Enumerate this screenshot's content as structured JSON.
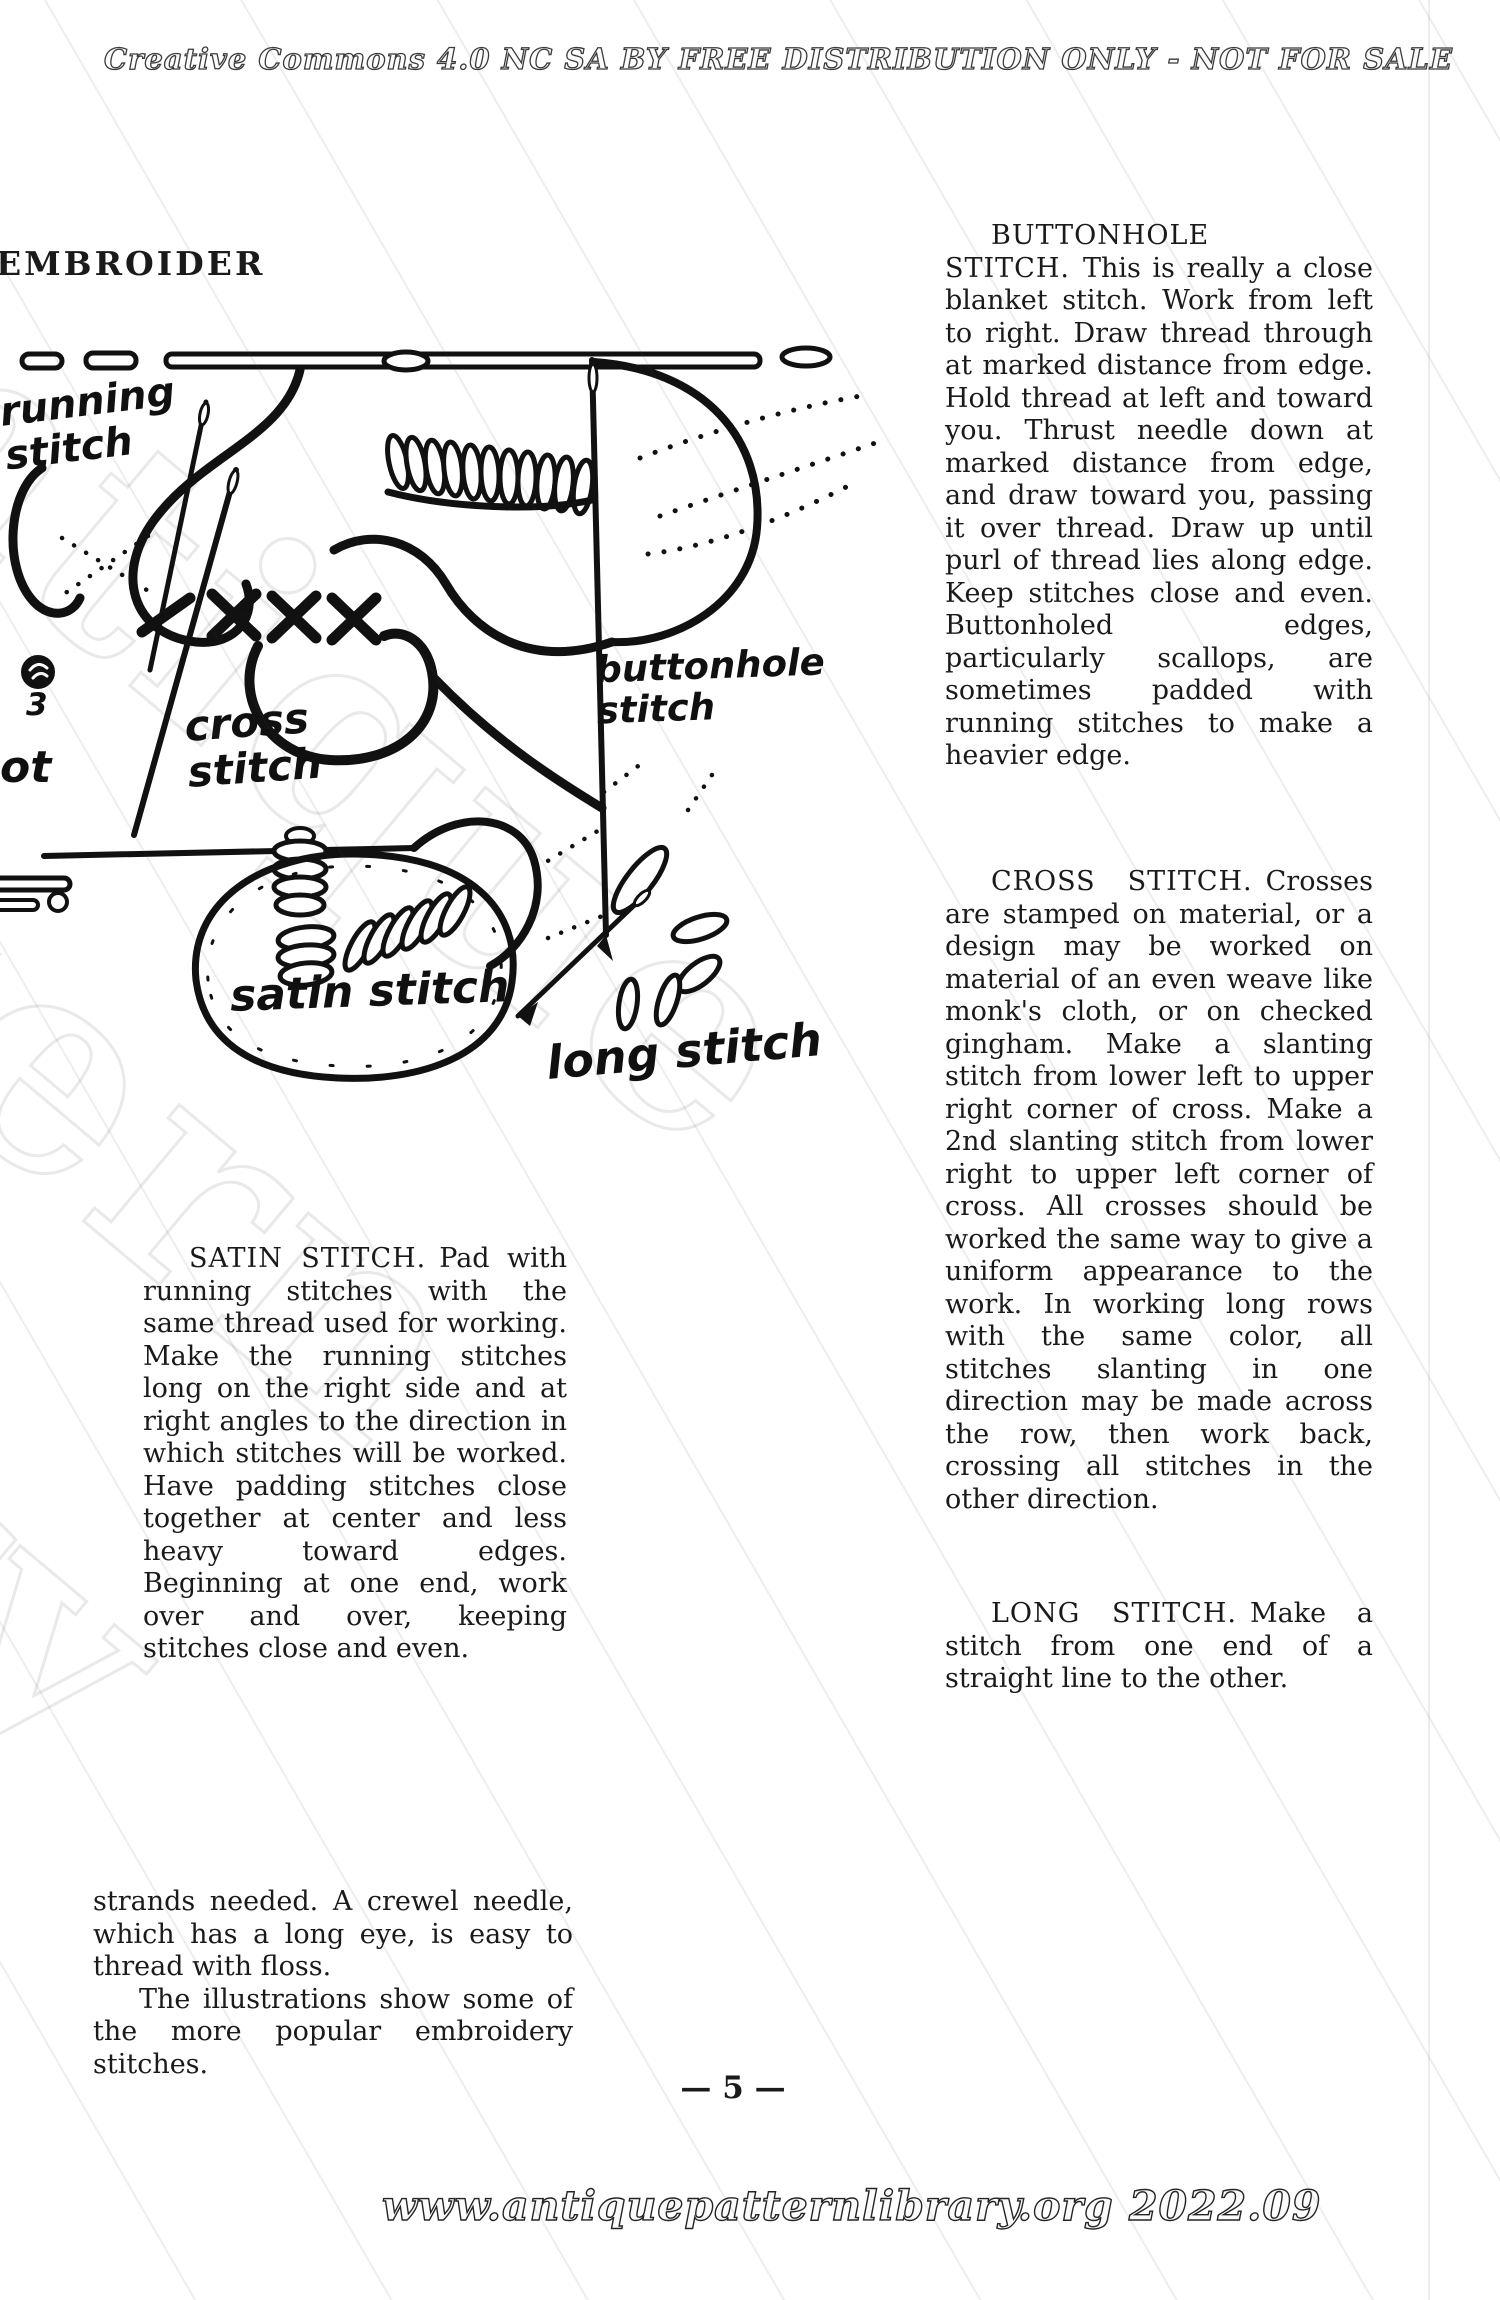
{
  "page": {
    "header": "Creative Commons 4.0 NC SA BY FREE DISTRIBUTION ONLY - NOT FOR SALE",
    "watermark": "Antique Pattern Library",
    "page_number": "— 5 —",
    "footer": "www.antiquepatternlibrary.org 2022.09"
  },
  "left_column": {
    "heading": "EMBROIDER",
    "satin": {
      "title": "SATIN STITCH.",
      "body": "Pad with running stitches with the same thread used for working. Make the running stitches long on the right side and at right angles to the direction in which stitches will be worked. Have padding stitches close together at center and less heavy toward edges. Beginning at one end, work over and over, keeping stitches close and even."
    },
    "closing": {
      "p1": "strands needed. A crewel needle, which has a long eye, is easy to thread with floss.",
      "p2": "The illustrations show some of the more popular embroidery stitches."
    }
  },
  "right_column": {
    "buttonhole": {
      "title": "BUTTONHOLE STITCH.",
      "body": "This is really a close blanket stitch. Work from left to right. Draw thread through at marked distance from edge. Hold thread at left and toward you. Thrust needle down at marked distance from edge, and draw toward you, passing it over thread. Draw up until purl of thread lies along edge. Keep stitches close and even. Buttonholed edges, particularly scallops, are sometimes padded with running stitches to make a heavier edge."
    },
    "cross": {
      "title": "CROSS STITCH.",
      "body": "Crosses are stamped on material, or a design may be worked on material of an even weave like monk's cloth, or on checked gingham. Make a slanting stitch from lower left to upper right corner of cross. Make a 2nd slanting stitch from lower right to upper left corner of cross. All crosses should be worked the same way to give a uniform appearance to the work. In working long rows with the same color, all stitches slanting in one direction may be made across the row, then work back, crossing all stitches in the other direction."
    },
    "long": {
      "title": "LONG STITCH.",
      "body": "Make a stitch from one end of a straight line to the other."
    }
  },
  "illustration": {
    "labels": {
      "running": "running stitch",
      "cross": "cross stitch",
      "buttonhole": "buttonhole stitch",
      "satin": "satin stitch",
      "long": "long stitch",
      "knot_number": "3",
      "knot_partial": "ot"
    }
  }
}
